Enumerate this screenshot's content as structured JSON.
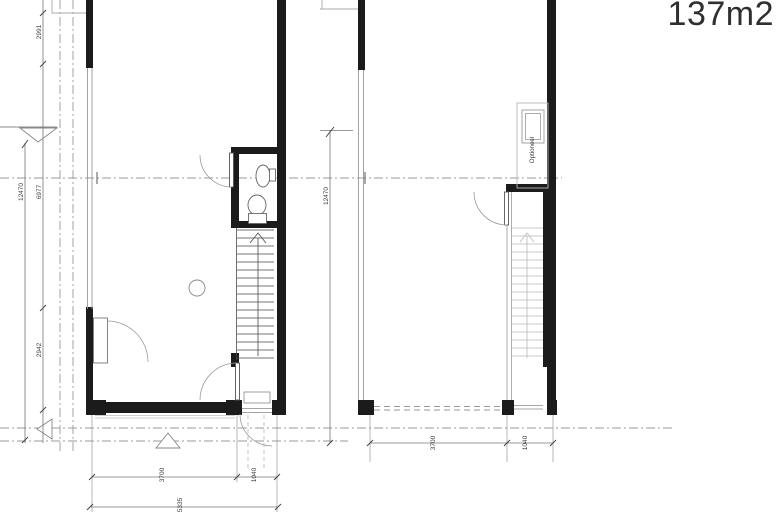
{
  "header": {
    "area_label": "137m2"
  },
  "palette": {
    "background": "#ffffff",
    "wall": "#1b1b1b",
    "thin_line": "#8a8a8a",
    "light_line": "#b8b8b8",
    "grid_line": "#9a9a9a",
    "dim_text": "#3d3d3d",
    "area_text": "#2f2f2f"
  },
  "plan_left": {
    "dims": {
      "v1": "2991",
      "v_total": "12470",
      "v2": "6977",
      "v3": "2942",
      "h1": "3700",
      "h2": "1040",
      "h_total": "5335"
    }
  },
  "plan_right": {
    "storage_label": "Optioneel",
    "dims": {
      "v_total": "12470",
      "h1": "3700",
      "h2": "1040"
    }
  }
}
